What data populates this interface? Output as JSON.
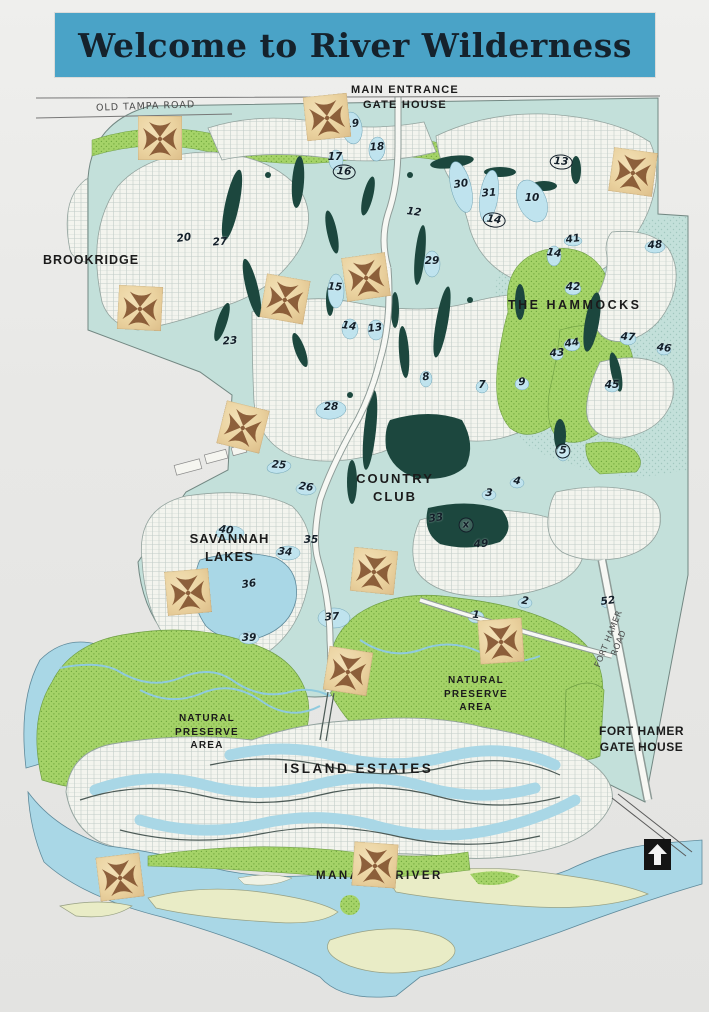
{
  "title": {
    "text": "Welcome to River Wilderness"
  },
  "colors": {
    "banner": "#4aa3c7",
    "banner-ink": "#15222c",
    "paper": "#e8e8e6",
    "teal": "#c3e0da",
    "green": "#a5d368",
    "green-dot": "#71a93e",
    "water": "#a9d7e6",
    "pond": "#bfe3ee",
    "fairway": "#1c473e",
    "sand": "#e9ecc6",
    "stamp1": "#f2e0b6",
    "stamp2": "#ddbe8a",
    "stamp-ink": "#74411f",
    "label-ink": "#1b1b1b",
    "number-ink": "#131f29",
    "road-ink": "#4a4a4a"
  },
  "map": {
    "labels": [
      {
        "id": "old-tampa-road",
        "text": "OLD TAMPA ROAD",
        "x": 96,
        "y": 101,
        "size": 9.5,
        "ls": 1,
        "rot": -2,
        "style": "road"
      },
      {
        "id": "main-entrance-gate-house",
        "text": "MAIN ENTRANCE\nGATE HOUSE",
        "x": 330,
        "y": 83,
        "w": 150,
        "size": 11,
        "ls": 1.2
      },
      {
        "id": "brookridge",
        "text": "BROOKRIDGE",
        "x": 43,
        "y": 252,
        "size": 12.5,
        "ls": 1
      },
      {
        "id": "the-hammocks",
        "text": "THE HAMMOCKS",
        "x": 508,
        "y": 297,
        "size": 12.5,
        "ls": 2.5
      },
      {
        "id": "country-club",
        "text": "COUNTRY\nCLUB",
        "x": 340,
        "y": 470,
        "w": 110,
        "size": 13,
        "ls": 2
      },
      {
        "id": "savannah-lakes",
        "text": "SAVANNAH\nLAKES",
        "x": 172,
        "y": 530,
        "w": 115,
        "size": 13,
        "ls": 1
      },
      {
        "id": "natural-preserve-area-east",
        "text": "NATURAL\nPRESERVE\nAREA",
        "x": 433,
        "y": 674,
        "w": 86,
        "size": 10,
        "ls": 1.2
      },
      {
        "id": "natural-preserve-area-west",
        "text": "NATURAL\nPRESERVE\nAREA",
        "x": 164,
        "y": 712,
        "w": 86,
        "size": 10,
        "ls": 1.2
      },
      {
        "id": "island-estates",
        "text": "ISLAND ESTATES",
        "x": 284,
        "y": 760,
        "size": 13.5,
        "ls": 2.5
      },
      {
        "id": "fort-hamer-gate-house",
        "text": "FORT HAMER\nGATE HOUSE",
        "x": 594,
        "y": 723,
        "w": 95,
        "size": 12,
        "ls": 0.5
      },
      {
        "id": "fort-hamer-road",
        "text": "FORT HAMER ROAD",
        "x": 570,
        "y": 630,
        "w": 90,
        "size": 8.5,
        "ls": 0.5,
        "rot": -68,
        "style": "road"
      },
      {
        "id": "manatee-river",
        "text": "MANATEE RIVER",
        "x": 316,
        "y": 869,
        "size": 11.5,
        "ls": 2.5
      }
    ],
    "numbers": [
      {
        "t": "19",
        "x": 352,
        "y": 124
      },
      {
        "t": "18",
        "x": 377,
        "y": 147
      },
      {
        "t": "17",
        "x": 335,
        "y": 157
      },
      {
        "t": "16",
        "x": 344,
        "y": 172,
        "c": true
      },
      {
        "t": "12",
        "x": 414,
        "y": 212
      },
      {
        "t": "30",
        "x": 461,
        "y": 184
      },
      {
        "t": "31",
        "x": 489,
        "y": 193
      },
      {
        "t": "10",
        "x": 532,
        "y": 198
      },
      {
        "t": "13",
        "x": 561,
        "y": 162,
        "c": true
      },
      {
        "t": "14",
        "x": 494,
        "y": 220,
        "c": true
      },
      {
        "t": "20",
        "x": 184,
        "y": 238
      },
      {
        "t": "27",
        "x": 220,
        "y": 242
      },
      {
        "t": "29",
        "x": 432,
        "y": 261
      },
      {
        "t": "15",
        "x": 335,
        "y": 287
      },
      {
        "t": "14",
        "x": 349,
        "y": 326
      },
      {
        "t": "13",
        "x": 375,
        "y": 328
      },
      {
        "t": "23",
        "x": 230,
        "y": 341
      },
      {
        "t": "28",
        "x": 331,
        "y": 407
      },
      {
        "t": "25",
        "x": 279,
        "y": 465
      },
      {
        "t": "26",
        "x": 306,
        "y": 487
      },
      {
        "t": "8",
        "x": 426,
        "y": 377
      },
      {
        "t": "9",
        "x": 522,
        "y": 382
      },
      {
        "t": "7",
        "x": 482,
        "y": 385
      },
      {
        "t": "5",
        "x": 563,
        "y": 451,
        "c": true
      },
      {
        "t": "14",
        "x": 554,
        "y": 253
      },
      {
        "t": "41",
        "x": 573,
        "y": 239
      },
      {
        "t": "48",
        "x": 655,
        "y": 245
      },
      {
        "t": "42",
        "x": 573,
        "y": 287
      },
      {
        "t": "47",
        "x": 628,
        "y": 337
      },
      {
        "t": "46",
        "x": 664,
        "y": 348
      },
      {
        "t": "44",
        "x": 572,
        "y": 343
      },
      {
        "t": "43",
        "x": 557,
        "y": 353
      },
      {
        "t": "45",
        "x": 612,
        "y": 385
      },
      {
        "t": "3",
        "x": 489,
        "y": 493
      },
      {
        "t": "4",
        "x": 517,
        "y": 481
      },
      {
        "t": "33",
        "x": 436,
        "y": 518
      },
      {
        "t": "49",
        "x": 481,
        "y": 544
      },
      {
        "t": "35",
        "x": 311,
        "y": 540
      },
      {
        "t": "34",
        "x": 285,
        "y": 552
      },
      {
        "t": "40",
        "x": 226,
        "y": 530
      },
      {
        "t": "36",
        "x": 249,
        "y": 584
      },
      {
        "t": "37",
        "x": 332,
        "y": 617
      },
      {
        "t": "39",
        "x": 249,
        "y": 638
      },
      {
        "t": "1",
        "x": 476,
        "y": 615
      },
      {
        "t": "2",
        "x": 525,
        "y": 601
      },
      {
        "t": "52",
        "x": 608,
        "y": 601
      },
      {
        "t": "x",
        "x": 466,
        "y": 525,
        "c": true
      }
    ],
    "markers": [
      {
        "x": 160,
        "y": 138,
        "r": 0
      },
      {
        "x": 327,
        "y": 117,
        "r": -6
      },
      {
        "x": 633,
        "y": 172,
        "r": 8
      },
      {
        "x": 140,
        "y": 308,
        "r": 3
      },
      {
        "x": 285,
        "y": 299,
        "r": 10
      },
      {
        "x": 366,
        "y": 277,
        "r": -8
      },
      {
        "x": 243,
        "y": 427,
        "r": 14
      },
      {
        "x": 188,
        "y": 592,
        "r": -5
      },
      {
        "x": 374,
        "y": 571,
        "r": 6
      },
      {
        "x": 501,
        "y": 641,
        "r": -4
      },
      {
        "x": 348,
        "y": 671,
        "r": 9
      },
      {
        "x": 120,
        "y": 877,
        "r": -7
      },
      {
        "x": 375,
        "y": 865,
        "r": 4
      }
    ],
    "north_arrow": {
      "x": 644,
      "y": 839
    }
  }
}
